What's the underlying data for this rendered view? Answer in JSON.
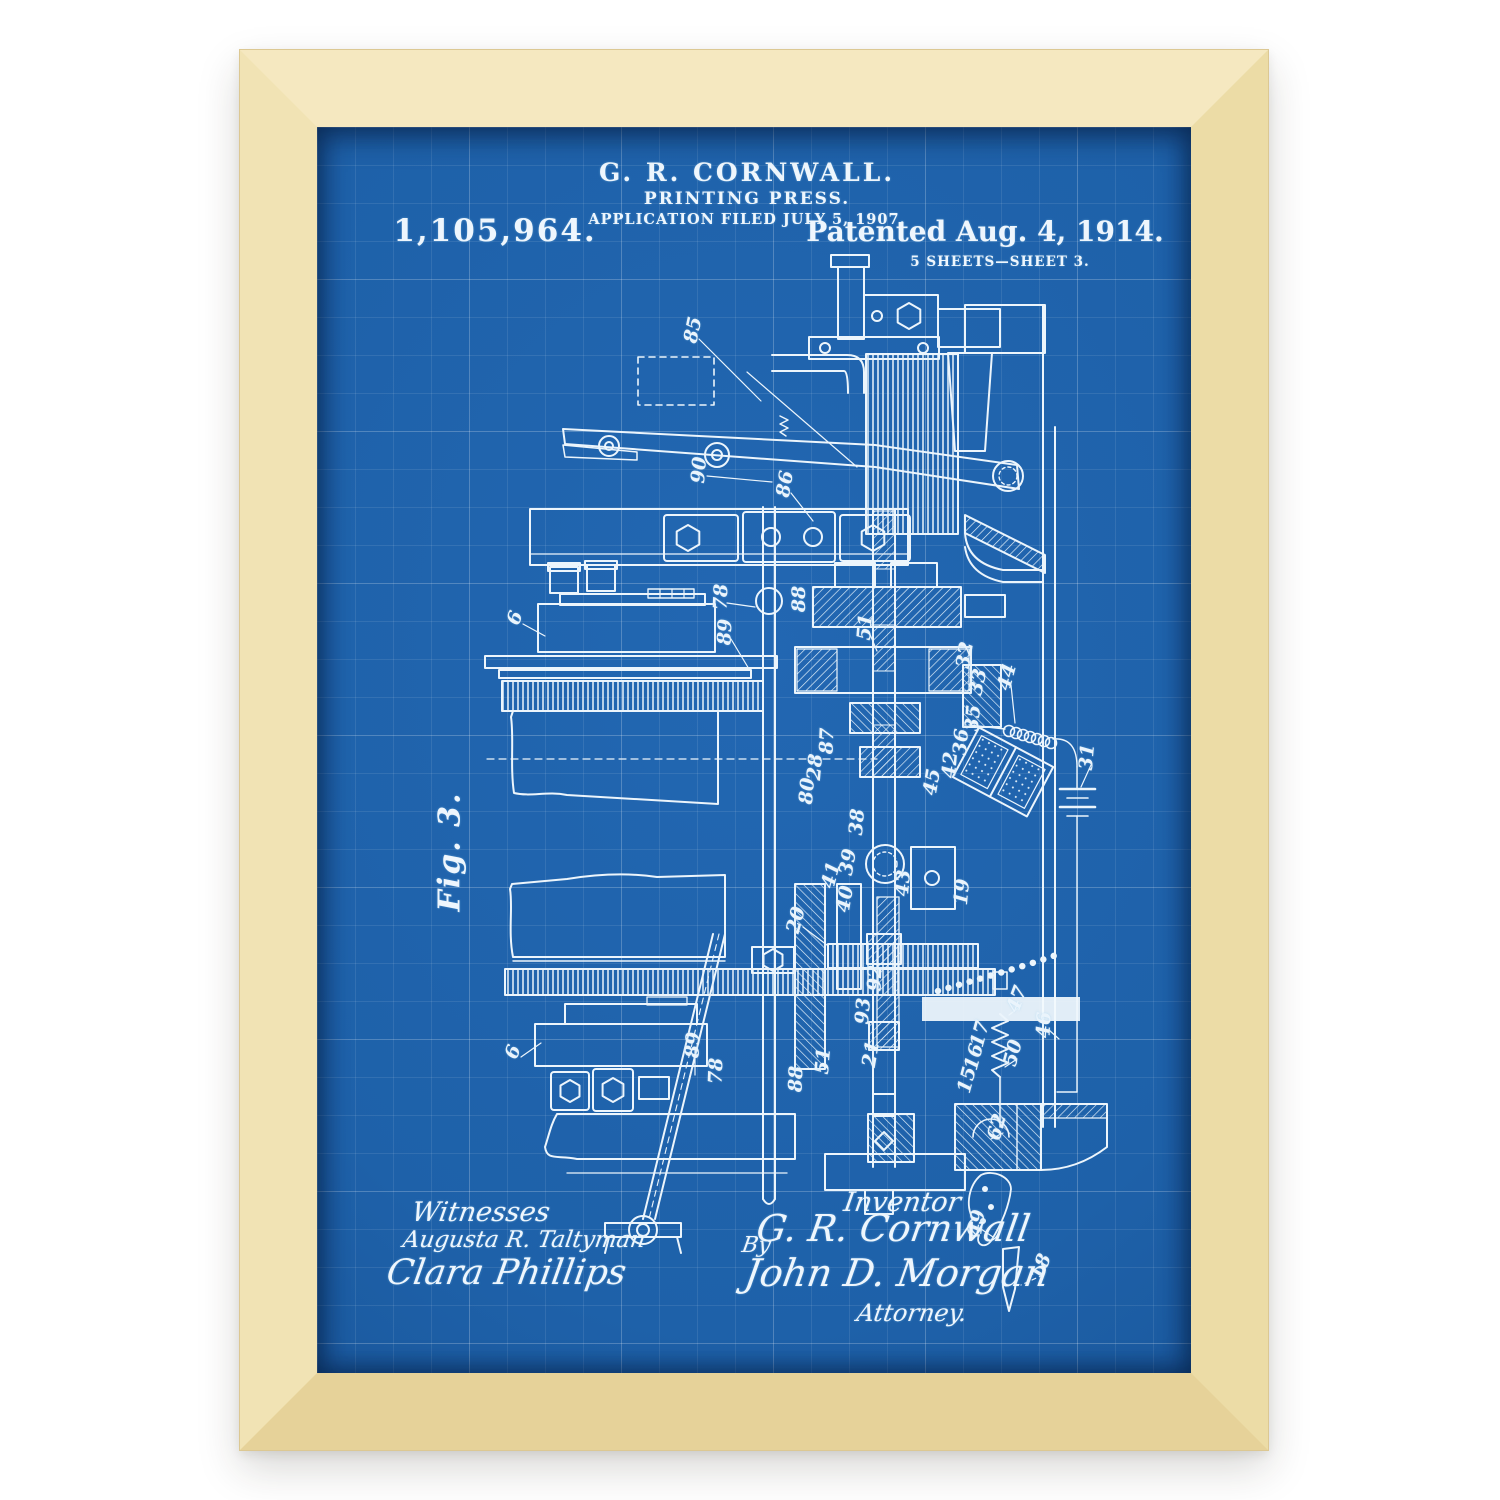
{
  "poster": {
    "header": {
      "inventor_line": "G. R. CORNWALL.",
      "title_line": "PRINTING PRESS.",
      "application_line": "APPLICATION FILED JULY 5, 1907.",
      "patent_number": "1,105,964.",
      "patented_line": "Patented Aug. 4, 1914.",
      "sheet_line": "5 SHEETS—SHEET 3."
    },
    "figure_label": "Fig. 3.",
    "signatures": {
      "witnesses_heading": "Witnesses",
      "witness_1": "Augusta R. Taltyman",
      "witness_2": "Clara Phillips",
      "inventor_heading": "Inventor",
      "inventor_signature": "G. R. Cornwall",
      "by_label": "By",
      "attorney_signature": "John D. Morgan",
      "attorney_heading": "Attorney."
    },
    "colors": {
      "blueprint_blue": "#1e61a9",
      "line_white": "#eef6fd",
      "wood_light": "#f5e8c0",
      "wood_dark": "#e6d299"
    },
    "part_labels": [
      {
        "n": "85",
        "x": 376,
        "y": 203,
        "r": -78
      },
      {
        "n": "90",
        "x": 382,
        "y": 343,
        "r": -85
      },
      {
        "n": "86",
        "x": 468,
        "y": 357,
        "r": -80
      },
      {
        "n": "78",
        "x": 404,
        "y": 470,
        "r": -88
      },
      {
        "n": "89",
        "x": 408,
        "y": 505,
        "r": -88
      },
      {
        "n": "6",
        "x": 198,
        "y": 491,
        "r": -70
      },
      {
        "n": "88",
        "x": 482,
        "y": 472,
        "r": -90
      },
      {
        "n": "51",
        "x": 548,
        "y": 500,
        "r": -85
      },
      {
        "n": "32",
        "x": 648,
        "y": 528,
        "r": -80
      },
      {
        "n": "33",
        "x": 661,
        "y": 555,
        "r": -78
      },
      {
        "n": "44",
        "x": 690,
        "y": 550,
        "r": -75
      },
      {
        "n": "35",
        "x": 656,
        "y": 591,
        "r": -85
      },
      {
        "n": "36",
        "x": 644,
        "y": 615,
        "r": -85
      },
      {
        "n": "42",
        "x": 633,
        "y": 638,
        "r": -85
      },
      {
        "n": "45",
        "x": 615,
        "y": 655,
        "r": -80
      },
      {
        "n": "38",
        "x": 540,
        "y": 695,
        "r": -85
      },
      {
        "n": "39",
        "x": 531,
        "y": 735,
        "r": -80
      },
      {
        "n": "41",
        "x": 514,
        "y": 748,
        "r": -75
      },
      {
        "n": "40",
        "x": 528,
        "y": 772,
        "r": -80
      },
      {
        "n": "43",
        "x": 586,
        "y": 756,
        "r": -85
      },
      {
        "n": "28",
        "x": 498,
        "y": 640,
        "r": -85
      },
      {
        "n": "87",
        "x": 510,
        "y": 614,
        "r": -88
      },
      {
        "n": "80",
        "x": 490,
        "y": 664,
        "r": -85
      },
      {
        "n": "31",
        "x": 770,
        "y": 630,
        "r": -85
      },
      {
        "n": "19",
        "x": 645,
        "y": 765,
        "r": -85
      },
      {
        "n": "46",
        "x": 727,
        "y": 898,
        "r": -88
      },
      {
        "n": "20",
        "x": 479,
        "y": 793,
        "r": -75
      },
      {
        "n": "92",
        "x": 558,
        "y": 851,
        "r": -88
      },
      {
        "n": "93",
        "x": 546,
        "y": 884,
        "r": -85
      },
      {
        "n": "21",
        "x": 554,
        "y": 927,
        "r": -80
      },
      {
        "n": "51",
        "x": 506,
        "y": 934,
        "r": -85
      },
      {
        "n": "88",
        "x": 479,
        "y": 952,
        "r": -88
      },
      {
        "n": "78",
        "x": 399,
        "y": 944,
        "r": -88
      },
      {
        "n": "17",
        "x": 663,
        "y": 907,
        "r": -75
      },
      {
        "n": "16",
        "x": 657,
        "y": 930,
        "r": -75
      },
      {
        "n": "15",
        "x": 650,
        "y": 953,
        "r": -75
      },
      {
        "n": "47",
        "x": 700,
        "y": 872,
        "r": -70
      },
      {
        "n": "50",
        "x": 696,
        "y": 926,
        "r": -75
      },
      {
        "n": "62",
        "x": 680,
        "y": 1000,
        "r": -75
      },
      {
        "n": "49",
        "x": 660,
        "y": 1096,
        "r": -80
      },
      {
        "n": "18",
        "x": 724,
        "y": 1140,
        "r": -70
      },
      {
        "n": "6",
        "x": 196,
        "y": 925,
        "r": -70
      },
      {
        "n": "89",
        "x": 376,
        "y": 918,
        "r": -88
      }
    ]
  }
}
